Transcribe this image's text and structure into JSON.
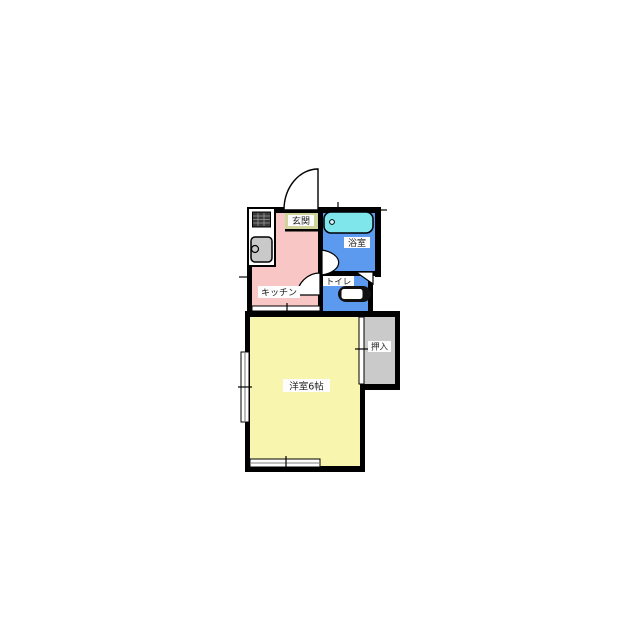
{
  "floorplan": {
    "type": "japanese-apartment-floor-plan",
    "rooms": {
      "genkan": {
        "label": "玄関",
        "color": "#d2d29c"
      },
      "bathroom": {
        "label": "浴室",
        "color": "#5b9aee"
      },
      "toilet": {
        "label": "トイレ",
        "color": "#5b9aee"
      },
      "kitchen": {
        "label": "キッチン",
        "color": "#f8c6c4"
      },
      "main_room": {
        "label": "洋室6帖",
        "color": "#f8f6ae"
      },
      "closet": {
        "label": "押入",
        "color": "#cacaca"
      }
    },
    "fixtures": {
      "bathtub_color": "#7fe6ec",
      "sink_color": "#c9c9c9",
      "stove_color": "#3a3a3a",
      "wall_color": "#000000",
      "background_color": "#ffffff",
      "label_bg_color": "#fdfdfd"
    }
  }
}
